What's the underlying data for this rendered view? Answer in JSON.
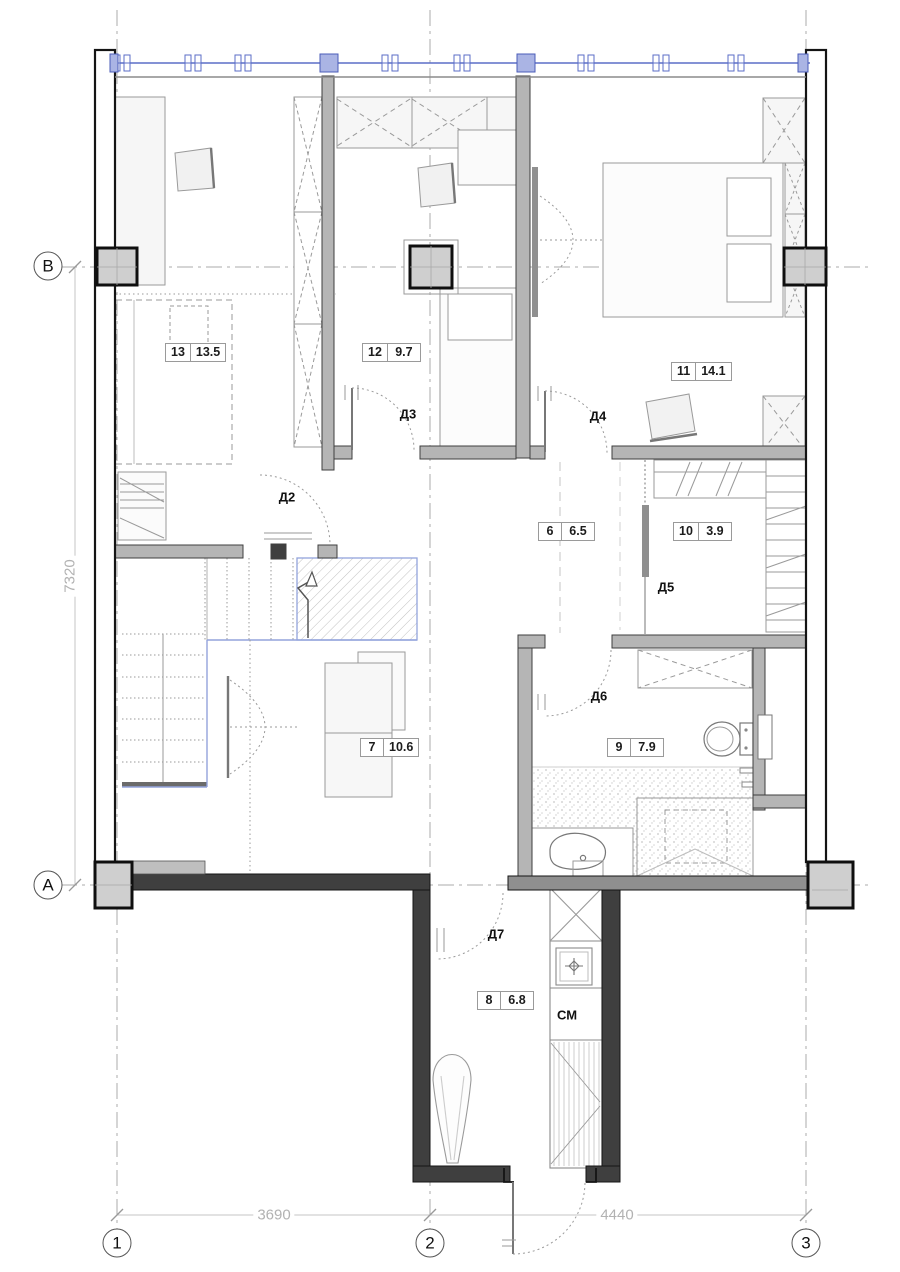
{
  "rooms": [
    {
      "number": "13",
      "area": "13.5"
    },
    {
      "number": "12",
      "area": "9.7"
    },
    {
      "number": "11",
      "area": "14.1"
    },
    {
      "number": "6",
      "area": "6.5"
    },
    {
      "number": "10",
      "area": "3.9"
    },
    {
      "number": "7",
      "area": "10.6"
    },
    {
      "number": "9",
      "area": "7.9"
    },
    {
      "number": "8",
      "area": "6.8"
    }
  ],
  "doors": [
    {
      "label": "Д2"
    },
    {
      "label": "Д3"
    },
    {
      "label": "Д4"
    },
    {
      "label": "Д5"
    },
    {
      "label": "Д6"
    },
    {
      "label": "Д7"
    }
  ],
  "labels": {
    "washing_machine": "СМ"
  },
  "grid": {
    "columns": [
      "1",
      "2",
      "3"
    ],
    "rows": [
      "А",
      "В"
    ]
  },
  "dimensions": {
    "left_height": "7320",
    "span_1_2": "3690",
    "span_2_3": "4440"
  },
  "colors": {
    "window_blue": "#5b6ec7",
    "window_block": "#aab4e4",
    "stair_blue": "#93a3dc",
    "wall_fill": "#b5b5b5",
    "wall_dark": "#3f3f3f",
    "furniture_line": "#9a9a9a",
    "dim_gray": "#b2b2b2"
  }
}
